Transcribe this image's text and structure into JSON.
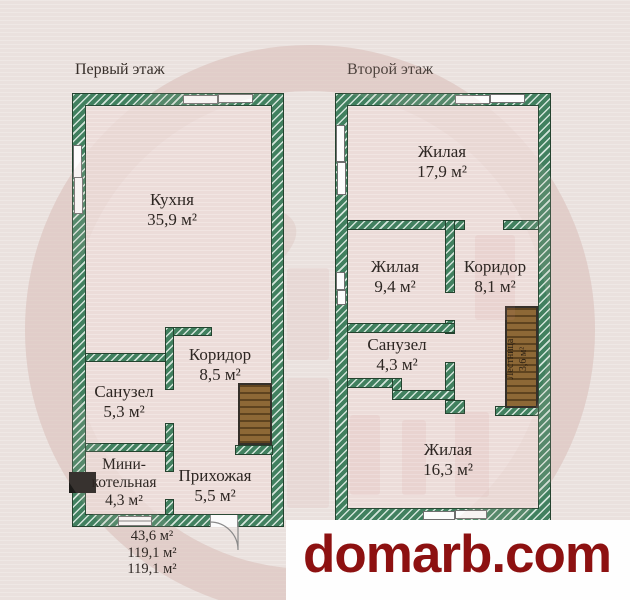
{
  "floor1": {
    "title": "Первый этаж",
    "rooms": {
      "kitchen": {
        "name": "Кухня",
        "area": "35,9 м²"
      },
      "corridor": {
        "name": "Коридор",
        "area": "8,5 м²"
      },
      "bathroom": {
        "name": "Санузел",
        "area": "5,3 м²"
      },
      "boiler_room": {
        "name_line1": "Мини-",
        "name_line2": "котельная",
        "area": "4,3 м²"
      },
      "hallway": {
        "name": "Прихожая",
        "area": "5,5 м²"
      }
    },
    "totals": {
      "line1": "43,6 м²",
      "line2": "119,1 м²",
      "line3": "119,1 м²"
    }
  },
  "floor2": {
    "title": "Второй этаж",
    "rooms": {
      "living_top": {
        "name": "Жилая",
        "area": "17,9 м²"
      },
      "living_mid": {
        "name": "Жилая",
        "area": "9,4 м²"
      },
      "corridor": {
        "name": "Коридор",
        "area": "8,1 м²"
      },
      "bathroom": {
        "name": "Санузел",
        "area": "4,3 м²"
      },
      "living_bottom": {
        "name": "Жилая",
        "area": "16,3 м²"
      },
      "stairs": {
        "name": "Лестница",
        "area": "3,6 м²"
      }
    }
  },
  "watermark": {
    "text": "domarb.com",
    "color": "#8d1111"
  },
  "colors": {
    "wall_green": "#41805f",
    "wall_outline": "#24432f",
    "floor_fill": "#ecdcd9",
    "background": "#eae1de",
    "stairs_wood": "#8d6836",
    "boiler_black": "#1c1b19",
    "label_text": "#2e2723",
    "watermark_red": "#8d1111"
  }
}
